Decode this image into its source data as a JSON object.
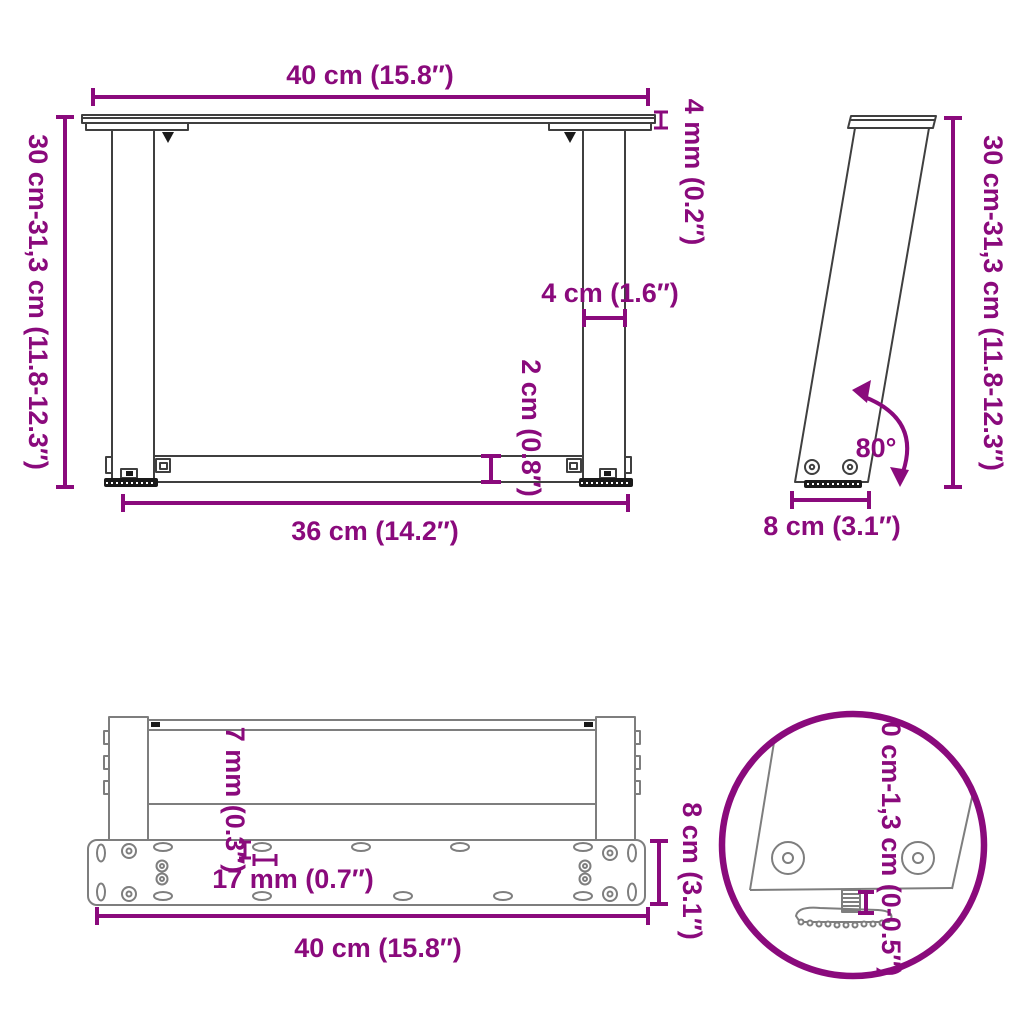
{
  "title": "U-shaped table legs dimension diagram",
  "colors": {
    "accent": "#8A0A7C",
    "line": "#3F3F3F",
    "gray": "#7E7E7E",
    "dark": "#1A1A1A",
    "background": "#FFFFFF"
  },
  "views": {
    "front": {
      "top_width": "40 cm (15.8″)",
      "plate_thickness": "4 mm (0.2″)",
      "height_range": "30 cm-31,3 cm (11.8-12.3″)",
      "leg_width": "4 cm (1.6″)",
      "crossbar_height": "2 cm (0.8″)",
      "bottom_width": "36 cm (14.2″)"
    },
    "side": {
      "height_range": "30 cm-31,3 cm (11.8-12.3″)",
      "angle": "80°",
      "foot_depth": "8 cm (3.1″)"
    },
    "plan": {
      "slot_width": "7 mm (0.3″)",
      "slot_length": "17 mm (0.7″)",
      "plate_depth": "8 cm (3.1″)",
      "plate_width": "40 cm (15.8″)"
    },
    "detail": {
      "foot_adjustment_range": "0 cm-1,3 cm (0-0.5″)"
    }
  }
}
